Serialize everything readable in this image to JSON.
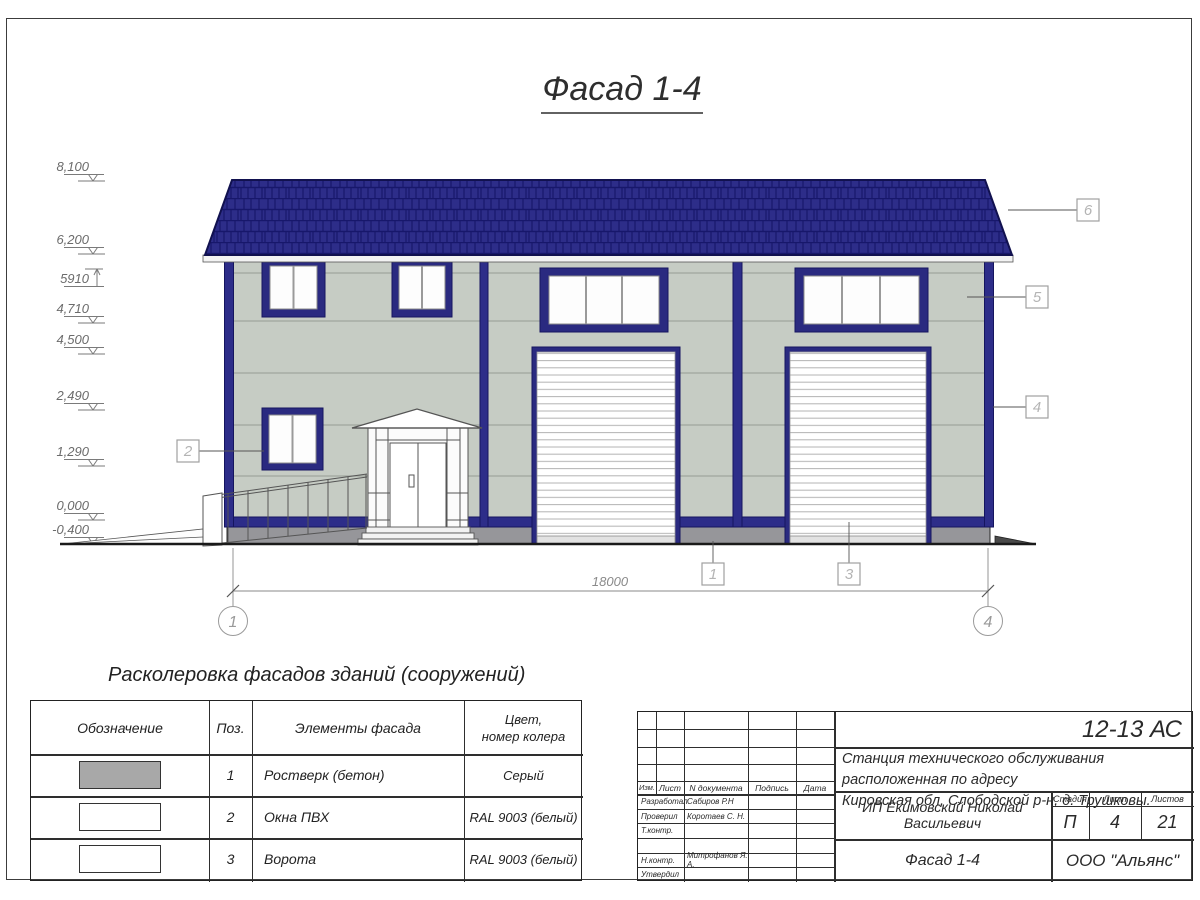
{
  "title": {
    "text": "Фасад 1-4"
  },
  "elevations": [
    "8,100",
    "6,200",
    "5910",
    "4,710",
    "4,500",
    "2,490",
    "1,290",
    "0,000",
    "-0,400"
  ],
  "dimension": {
    "total": "18000"
  },
  "axis_labels": [
    "1",
    "4"
  ],
  "callouts": [
    "1",
    "2",
    "3",
    "4",
    "5",
    "6"
  ],
  "colors": {
    "roof_blue": "#2d2d89",
    "frame_blue": "#2a2a80",
    "wall_gray_green": "#c6ccc4",
    "plinth_gray": "#96969a",
    "legend_gray_swatch": "#a8a8a8",
    "white": "#ffffff"
  },
  "legend": {
    "title": "Расколеровка фасадов зданий (сооружений)",
    "headers": {
      "designation": "Обозначение",
      "pos": "Поз.",
      "element": "Элементы фасада",
      "color_line1": "Цвет,",
      "color_line2": "номер колера"
    },
    "rows": [
      {
        "pos": "1",
        "element": "Ростверк (бетон)",
        "color": "Серый",
        "swatch": "#a8a8a8"
      },
      {
        "pos": "2",
        "element": "Окна ПВХ",
        "color": "RAL 9003 (белый)",
        "swatch": "#ffffff"
      },
      {
        "pos": "3",
        "element": "Ворота",
        "color": "RAL 9003 (белый)",
        "swatch": "#ffffff"
      }
    ]
  },
  "titleblock": {
    "doc_code": "12-13 АС",
    "project_line1": "Станция технического обслуживания расположенная по адресу",
    "project_line2": "Кировская обл, Слободской р-н, д. Трушковы.",
    "cols": {
      "izm": "Изм.",
      "list": "Лист",
      "doc": "N документа",
      "sign": "Подпись",
      "date": "Дата"
    },
    "roles": [
      {
        "role": "Разработал",
        "name": "Сабиров Р.Н"
      },
      {
        "role": "Проверил",
        "name": "Коротаев С. Н."
      },
      {
        "role": "Т.контр.",
        "name": ""
      },
      {
        "role": "",
        "name": ""
      },
      {
        "role": "Н.контр.",
        "name": "Митрофанов Я. А."
      },
      {
        "role": "Утвердил",
        "name": ""
      }
    ],
    "client": "ИП Екимовский Николай Васильевич",
    "sheet_title": "Фасад 1-4",
    "stage_label": "Стадия",
    "sheet_label": "Лист",
    "sheets_label": "Листов",
    "stage": "П",
    "sheet_no": "4",
    "sheets_total": "21",
    "company": "ООО \"Альянс\""
  }
}
